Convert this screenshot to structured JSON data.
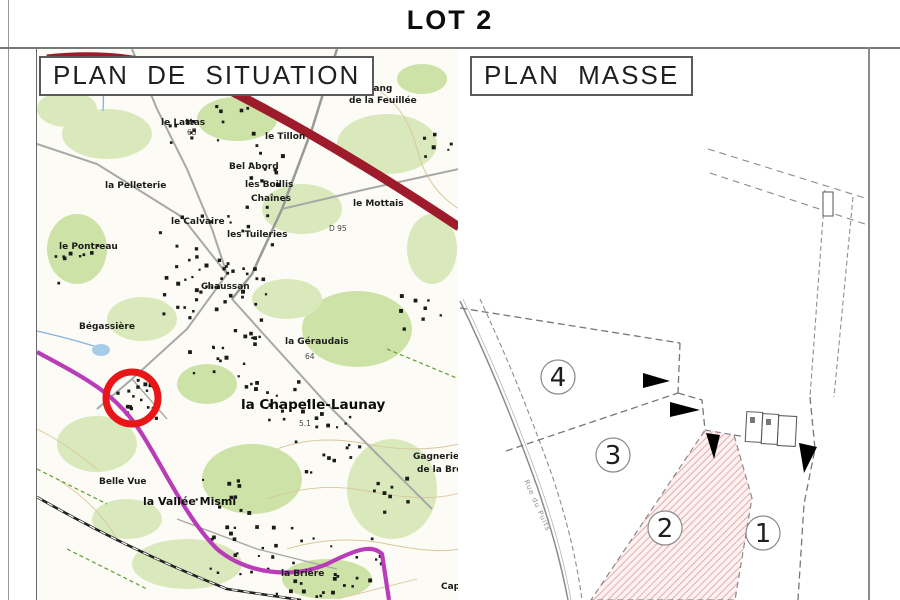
{
  "title": "LOT 2",
  "panels": {
    "situation": {
      "label": "PLAN DE SITUATION"
    },
    "masse": {
      "label": "PLAN MASSE"
    }
  },
  "situation": {
    "marker_color": "#e81616",
    "highway_color": "#9e1b2b",
    "road_color": "#b93cb9",
    "labels": [
      "étang",
      "de la Feuillée",
      "le Lattas",
      "le Tillon",
      "Bel Abord",
      "les Boillis",
      "Chaînes",
      "le Mottais",
      "la Pelleterie",
      "le Pontreau",
      "le Calvaire",
      "les Tuileries",
      "D 95",
      "Chaussan",
      "Bégassière",
      "la Géraudais",
      "65",
      "64",
      "la Chapelle-Launay",
      "5.1",
      "Gagnerie",
      "de la Bro",
      "Belle Vue",
      "la Vallée Mismi",
      "la Brière",
      "Capr"
    ]
  },
  "masse": {
    "lots": [
      "4",
      "3",
      "2",
      "1"
    ],
    "road_label": "Rue du Puits",
    "lot2_hatch_color": "#e09b9b"
  }
}
